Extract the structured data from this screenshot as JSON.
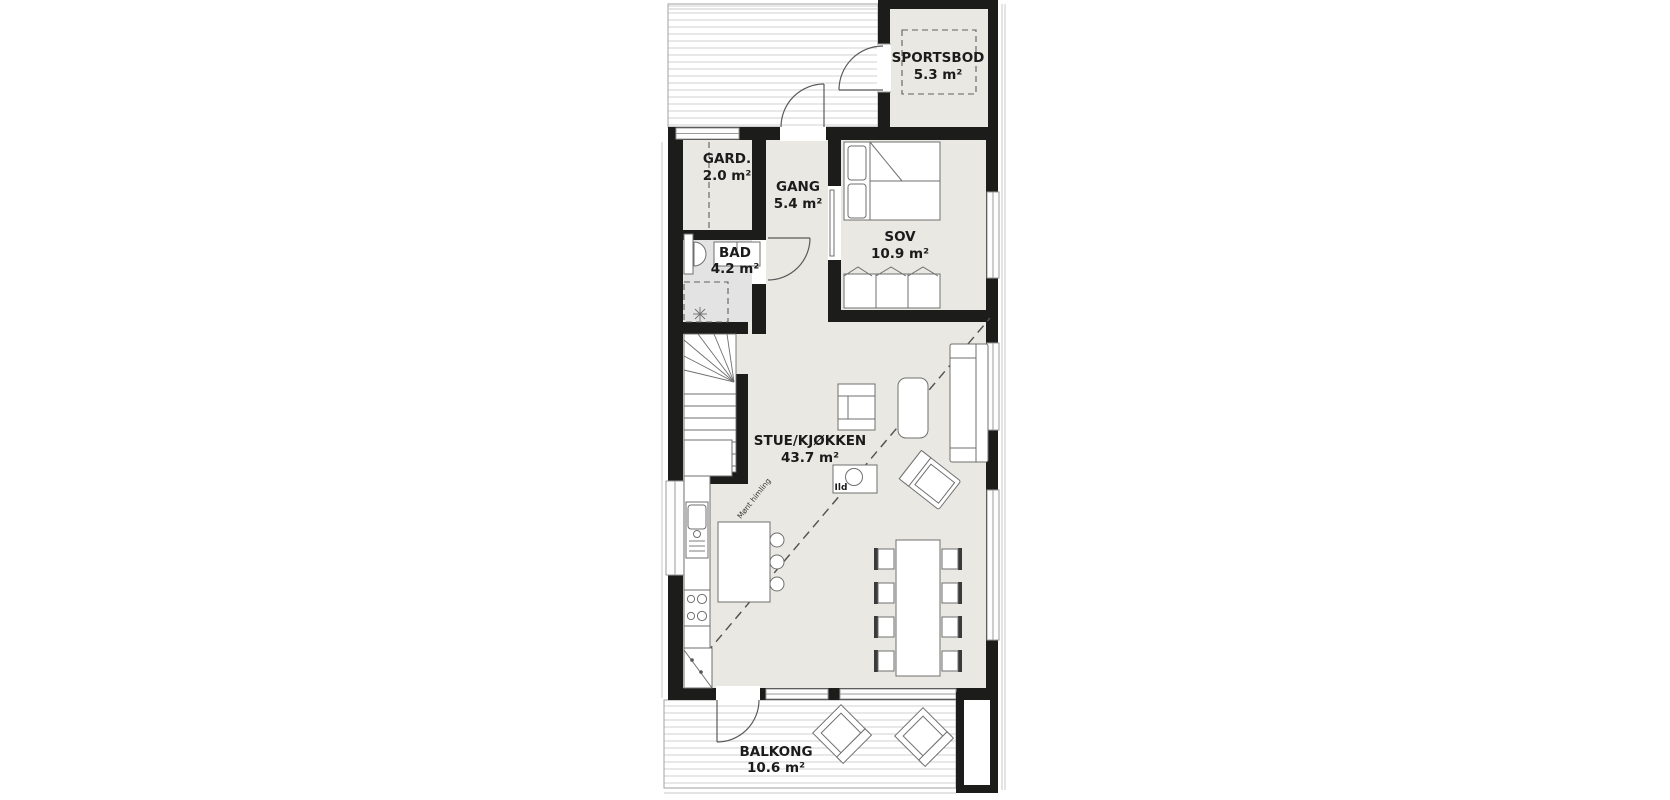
{
  "rooms": [
    {
      "id": "sportsbod",
      "name": "SPORTSBOD",
      "area": "5.3 m²"
    },
    {
      "id": "gard",
      "name": "GARD.",
      "area": "2.0 m²"
    },
    {
      "id": "gang",
      "name": "GANG",
      "area": "5.4 m²"
    },
    {
      "id": "bad",
      "name": "BAD",
      "area": "4.2 m²"
    },
    {
      "id": "sov",
      "name": "SOV",
      "area": "10.9 m²"
    },
    {
      "id": "stue-kjokken",
      "name": "STUE/KJØKKEN",
      "area": "43.7 m²"
    },
    {
      "id": "balkong",
      "name": "BALKONG",
      "area": "10.6 m²"
    }
  ],
  "annotations": {
    "fireplace_label": "Ild",
    "ceiling_label": "Mønt himling"
  },
  "colors": {
    "wall": "#1c1c1a",
    "floor": "#e9e8e2",
    "floor-bad": "#e3e3e3",
    "line": "#6f6f6f",
    "deck-line": "#d8d8d8",
    "label": "#1b1b1b"
  }
}
